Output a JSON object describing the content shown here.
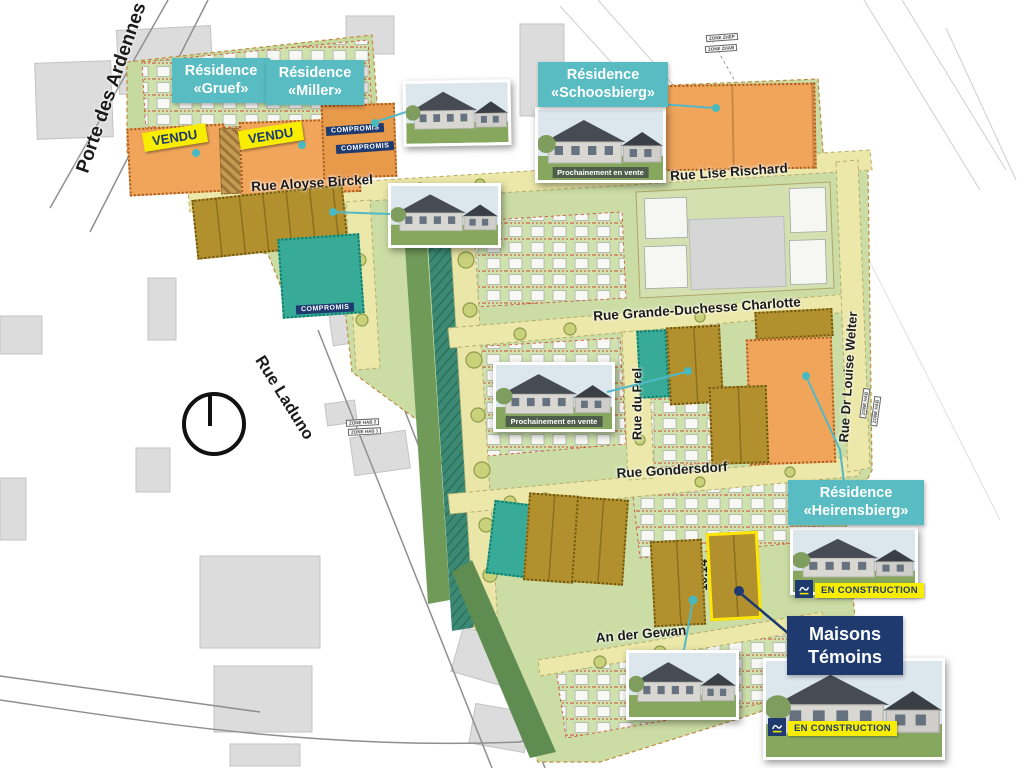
{
  "residences": {
    "gruef": {
      "line1": "Résidence",
      "line2": "«Gruef»"
    },
    "miller": {
      "line1": "Résidence",
      "line2": "«Miller»"
    },
    "schoosbierg": {
      "line1": "Résidence",
      "line2": "«Schoosbierg»"
    },
    "heirensbierg": {
      "line1": "Résidence",
      "line2": "«Heirensbierg»"
    }
  },
  "streets": {
    "porte_des_ardennes": "Porte des Ardennes",
    "rue_aloyse_birckel": "Rue Aloyse Birckel",
    "rue_lise_rischard": "Rue Lise Rischard",
    "rue_grande_duchesse_charlotte": "Rue Grande-Duchesse Charlotte",
    "rue_du_prel": "Rue du Prel",
    "rue_dr_louise_welter": "Rue Dr Louise Welter",
    "rue_gondersdorf": "Rue Gondersdorf",
    "rue_laduno": "Rue Laduno",
    "an_der_gewan": "An der Gewan"
  },
  "plots": {
    "p3_1": "3.1",
    "p2_1": "2.1",
    "p2_2": "2.2",
    "p2_3": "2.3",
    "p2_4": "2.4",
    "p16_1": "16.1",
    "p16_2": "16.2",
    "p4a_1": "4A.1",
    "p4a_2": "4A.2",
    "p4a_3": "4A.3",
    "p4a_4": "4A.4",
    "p4a_5": "4A.5",
    "p4a_6": "4A.6",
    "p4a_7": "4A.7",
    "p4a_8": "4A.8",
    "p9a_1": "9A.1",
    "p9a_2": "9A.2",
    "p9a_3": "9A.3",
    "p9a_6": "9A.6",
    "p9a_7": "9A.7",
    "p9a_8": "9A.8",
    "p9b_6": "9B.6",
    "p10_1": "10.1",
    "p10_2": "10.2",
    "p10_3": "10.3",
    "p10_4": "10.4",
    "p10_5": "10.5",
    "p10_12": "10.12",
    "p10_13": "10.13",
    "p10_14": "10.14",
    "p10_15": "10.15"
  },
  "tags": {
    "vendu": "VENDU",
    "compromis": "COMPROMIS",
    "vente_libre": "Vente libre",
    "prochainement": "Prochainement en vente",
    "en_construction": "EN CONSTRUCTION",
    "maisons_temoins_line1": "Maisons",
    "maisons_temoins_line2": "Témoins",
    "zone_zhep": "ZONE ZHEP",
    "zone_zhab": "ZONE ZHAB",
    "zone_hab_2": "ZONE HAB 2",
    "zone_hab_1": "ZONE HAB 1",
    "zone_hab": "ZONE HAB"
  },
  "colors": {
    "teal_box": "#58bcc2",
    "navy": "#1e3a6e",
    "vendu_yellow": "#f8ec00",
    "orange_plot": "#f0a55b",
    "gold_plot": "#b2902e",
    "teal_plot": "#37ab97",
    "site_green": "#cbdda4",
    "street_yellow": "#ece8a9",
    "highlight_yellow": "#ffe60a"
  }
}
